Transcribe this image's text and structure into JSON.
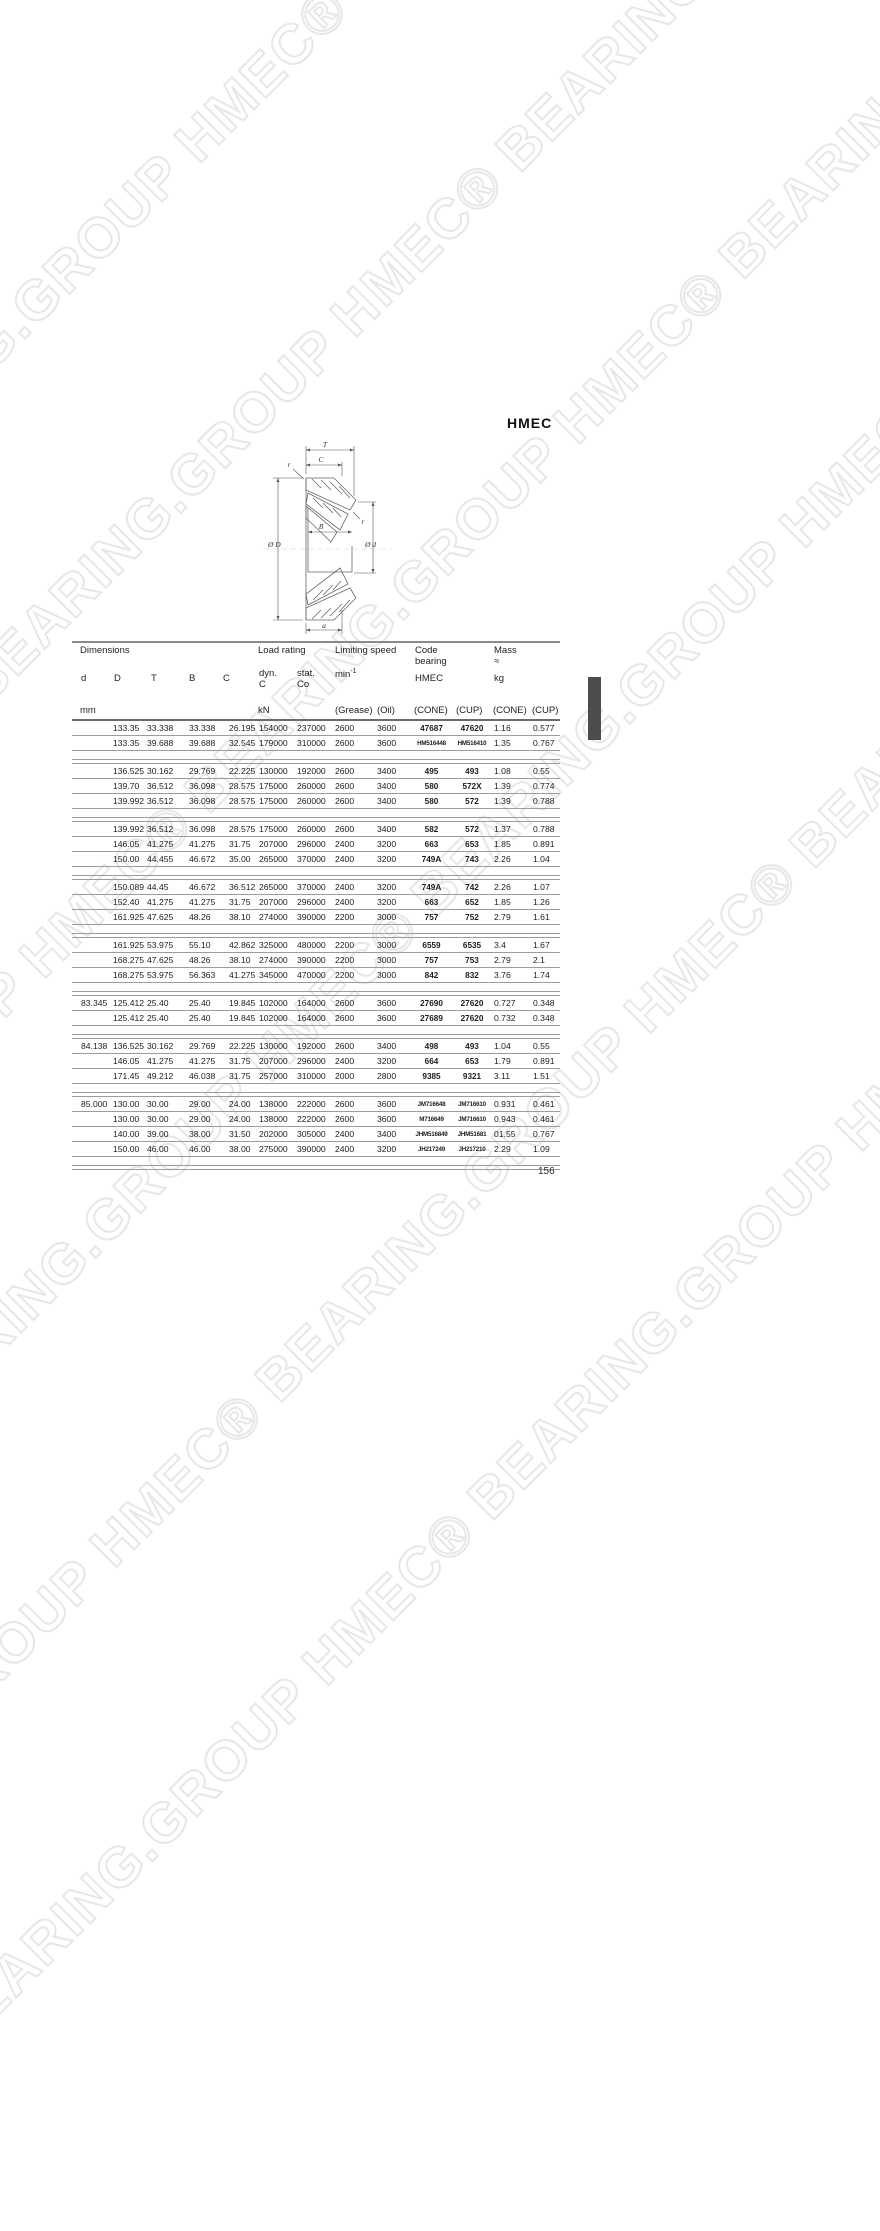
{
  "brand": "HMEC",
  "page_number": "156",
  "watermark": {
    "text": "HMEC® BEARING.GROUP",
    "outline_color": "#e7e7e7"
  },
  "diagram": {
    "labels": {
      "T": "T",
      "C": "C",
      "r_top": "r",
      "r_mid": "r",
      "B": "B",
      "outer_dia": "Ø D",
      "bore_dia": "Ø d",
      "a": "a"
    }
  },
  "table": {
    "header": {
      "dimensions": "Dimensions",
      "load_rating": "Load rating",
      "limiting_speed": "Limiting speed",
      "code_line1": "Code",
      "code_line2": "bearing",
      "mass": "Mass",
      "approx": "≈",
      "col_d": "d",
      "col_D": "D",
      "col_T": "T",
      "col_B": "B",
      "col_C": "C",
      "dyn_line1": "dyn.",
      "dyn_line2": "C",
      "stat_line1": "stat.",
      "stat_line2": "Co",
      "min_base": "min",
      "min_sup": "-1",
      "hmec": "HMEC",
      "kg": "kg",
      "unit_mm": "mm",
      "unit_kn": "kN",
      "unit_grease": "(Grease)",
      "unit_oil": "(Oil)",
      "unit_cone": "(CONE)",
      "unit_cup": "(CUP)",
      "unit_mass_cone": "(CONE)",
      "unit_mass_cup": "(CUP)"
    },
    "columns": [
      "d",
      "D",
      "T",
      "B",
      "C",
      "dyn. C",
      "stat. Co",
      "Grease",
      "Oil",
      "CONE",
      "CUP",
      "Mass CONE",
      "Mass CUP"
    ],
    "groups": [
      [
        [
          "",
          "133.35",
          "33.338",
          "33.338",
          "26.195",
          "154000",
          "237000",
          "2600",
          "3600",
          "47687",
          "47620",
          "1.16",
          "0.577"
        ],
        [
          "",
          "133.35",
          "39.688",
          "39.688",
          "32.545",
          "179000",
          "310000",
          "2600",
          "3600",
          "HM516448",
          "HM516410",
          "1.35",
          "0.767"
        ]
      ],
      [
        [
          "",
          "136.525",
          "30.162",
          "29.769",
          "22.225",
          "130000",
          "192000",
          "2600",
          "3400",
          "495",
          "493",
          "1.08",
          "0.55"
        ],
        [
          "",
          "139.70",
          "36.512",
          "36.098",
          "28.575",
          "175000",
          "260000",
          "2600",
          "3400",
          "580",
          "572X",
          "1.39",
          "0.774"
        ],
        [
          "",
          "139.992",
          "36.512",
          "36.098",
          "28.575",
          "175000",
          "260000",
          "2600",
          "3400",
          "580",
          "572",
          "1.39",
          "0.788"
        ]
      ],
      [
        [
          "",
          "139.992",
          "36.512",
          "36.098",
          "28.575",
          "175000",
          "260000",
          "2600",
          "3400",
          "582",
          "572",
          "1.37",
          "0.788"
        ],
        [
          "",
          "146.05",
          "41.275",
          "41.275",
          "31.75",
          "207000",
          "296000",
          "2400",
          "3200",
          "663",
          "653",
          "1.85",
          "0.891"
        ],
        [
          "",
          "150.00",
          "44.455",
          "46.672",
          "35.00",
          "265000",
          "370000",
          "2400",
          "3200",
          "749A",
          "743",
          "2.26",
          "1.04"
        ]
      ],
      [
        [
          "",
          "150.089",
          "44.45",
          "46.672",
          "36.512",
          "265000",
          "370000",
          "2400",
          "3200",
          "749A",
          "742",
          "2.26",
          "1.07"
        ],
        [
          "",
          "152.40",
          "41.275",
          "41.275",
          "31.75",
          "207000",
          "296000",
          "2400",
          "3200",
          "663",
          "652",
          "1.85",
          "1.26"
        ],
        [
          "",
          "161.925",
          "47.625",
          "48.26",
          "38.10",
          "274000",
          "390000",
          "2200",
          "3000",
          "757",
          "752",
          "2.79",
          "1.61"
        ]
      ],
      [
        [
          "",
          "161.925",
          "53.975",
          "55.10",
          "42.862",
          "325000",
          "480000",
          "2200",
          "3000",
          "6559",
          "6535",
          "3.4",
          "1.67"
        ],
        [
          "",
          "168.275",
          "47.625",
          "48.26",
          "38.10",
          "274000",
          "390000",
          "2200",
          "3000",
          "757",
          "753",
          "2.79",
          "2.1"
        ],
        [
          "",
          "168.275",
          "53.975",
          "56.363",
          "41.275",
          "345000",
          "470000",
          "2200",
          "3000",
          "842",
          "832",
          "3.76",
          "1.74"
        ]
      ],
      [
        [
          "83.345",
          "125.412",
          "25.40",
          "25.40",
          "19.845",
          "102000",
          "164000",
          "2600",
          "3600",
          "27690",
          "27620",
          "0.727",
          "0.348"
        ],
        [
          "",
          "125.412",
          "25.40",
          "25.40",
          "19.845",
          "102000",
          "164000",
          "2600",
          "3600",
          "27689",
          "27620",
          "0.732",
          "0.348"
        ]
      ],
      [
        [
          "84.138",
          "136.525",
          "30.162",
          "29.769",
          "22.225",
          "130000",
          "192000",
          "2600",
          "3400",
          "498",
          "493",
          "1.04",
          "0.55"
        ],
        [
          "",
          "146.05",
          "41.275",
          "41.275",
          "31.75",
          "207000",
          "296000",
          "2400",
          "3200",
          "664",
          "653",
          "1.79",
          "0.891"
        ],
        [
          "",
          "171.45",
          "49.212",
          "46.038",
          "31.75",
          "257000",
          "310000",
          "2000",
          "2800",
          "9385",
          "9321",
          "3.11",
          "1.51"
        ]
      ],
      [
        [
          "85.000",
          "130.00",
          "30.00",
          "29.00",
          "24.00",
          "138000",
          "222000",
          "2600",
          "3600",
          "JM716648",
          "JM716610",
          "0.931",
          "0.461"
        ],
        [
          "",
          "130.00",
          "30.00",
          "29.00",
          "24.00",
          "138000",
          "222000",
          "2600",
          "3600",
          "M716649",
          "JM716610",
          "0.943",
          "0.461"
        ],
        [
          "",
          "140.00",
          "39.00",
          "38.00",
          "31.50",
          "202000",
          "305000",
          "2400",
          "3400",
          "JHM516849",
          "JHM51681",
          "01.55",
          "0.767"
        ],
        [
          "",
          "150.00",
          "46.00",
          "46.00",
          "38.00",
          "275000",
          "390000",
          "2400",
          "3200",
          "JH217249",
          "JH217210",
          "2.29",
          "1.09"
        ]
      ]
    ]
  }
}
